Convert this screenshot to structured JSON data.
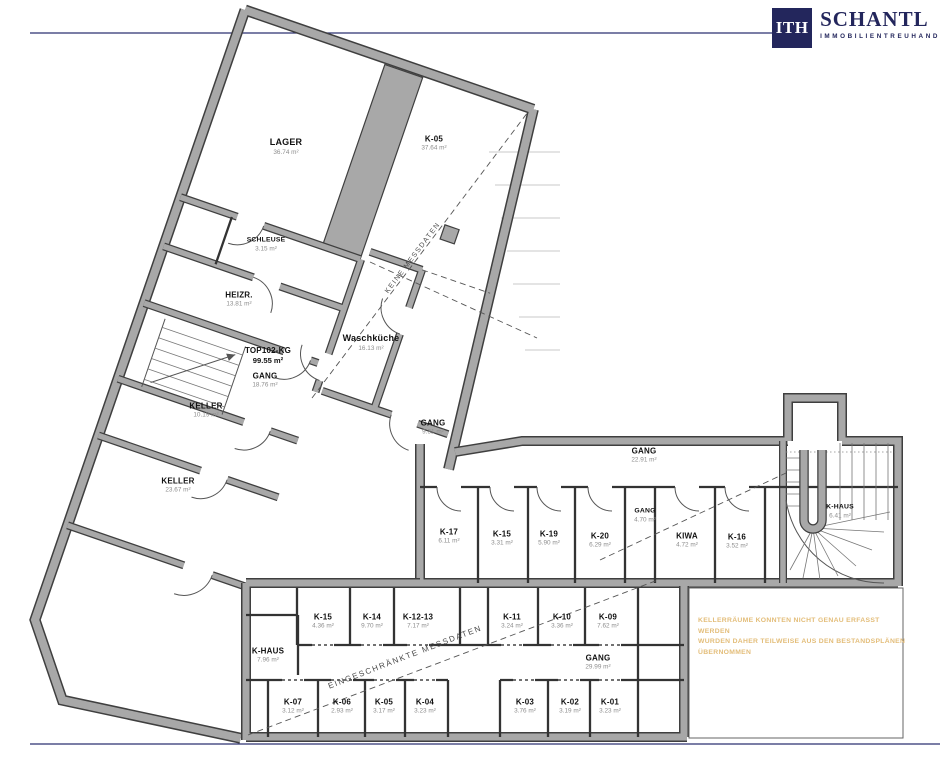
{
  "logo": {
    "mark": "ITH",
    "brand": "SCHANTL",
    "subtitle": "IMMOBILIENTREUHAND"
  },
  "annotations": {
    "no_measure_data": "KEINE MESSDATEN",
    "limited_measure_data": "EINGESCHRÄNKTE MESSDATEN"
  },
  "disclaimer": {
    "lines": [
      "KELLERRÄUME KONNTEN NICHT GENAU ERFASST WERDEN",
      "WURDEN DAHER TEILWEISE AUS DEN BESTANDSPLÄNEN",
      "ÜBERNOMMEN"
    ]
  },
  "rooms": [
    {
      "name": "LAGER",
      "area": "36.74 m²"
    },
    {
      "name": "K-05",
      "area": "37.64 m²"
    },
    {
      "name": "SCHLEUSE",
      "area": "3.15 m²"
    },
    {
      "name": "HEIZR.",
      "area": "13.81 m²"
    },
    {
      "name": "TOP102-KG",
      "area": "99.55 m²"
    },
    {
      "name": "GANG",
      "area": "18.76 m²"
    },
    {
      "name": "KELLER",
      "area": "10.19 m²"
    },
    {
      "name": "KELLER",
      "area": "23.67 m²"
    },
    {
      "name": "Waschküche",
      "area": "16.13 m²"
    },
    {
      "name": "GANG",
      "area": "9.31 m²"
    },
    {
      "name": "GANG",
      "area": "22.91 m²"
    },
    {
      "name": "K-17",
      "area": "6.11 m²"
    },
    {
      "name": "K-15",
      "area": "3.31 m²"
    },
    {
      "name": "K-19",
      "area": "5.90 m²"
    },
    {
      "name": "K-20",
      "area": "6.29 m²"
    },
    {
      "name": "GANG",
      "area": "4.70 m²"
    },
    {
      "name": "KIWA",
      "area": "4.72 m²"
    },
    {
      "name": "K-16",
      "area": "3.52 m²"
    },
    {
      "name": "K-HAUS",
      "area": "6.41 m²"
    },
    {
      "name": "K-HAUS",
      "area": "7.96 m²"
    },
    {
      "name": "K-15",
      "area": "4.36 m²"
    },
    {
      "name": "K-14",
      "area": "9.70 m²"
    },
    {
      "name": "K-12-13",
      "area": "7.17 m²"
    },
    {
      "name": "K-11",
      "area": "3.24 m²"
    },
    {
      "name": "K-10",
      "area": "3.36 m²"
    },
    {
      "name": "K-09",
      "area": "7.62 m²"
    },
    {
      "name": "GANG",
      "area": "29.99 m²"
    },
    {
      "name": "K-07",
      "area": "3.12 m²"
    },
    {
      "name": "K-06",
      "area": "2.93 m²"
    },
    {
      "name": "K-05",
      "area": "3.17 m²"
    },
    {
      "name": "K-04",
      "area": "3.23 m²"
    },
    {
      "name": "K-03",
      "area": "3.76 m²"
    },
    {
      "name": "K-02",
      "area": "3.19 m²"
    },
    {
      "name": "K-01",
      "area": "3.23 m²"
    }
  ],
  "colors": {
    "wall_gray": "#a8a8a8",
    "wall_edge": "#3f3f3f",
    "navy": "#23265c",
    "disclaimer_orange": "#e3bd79"
  }
}
